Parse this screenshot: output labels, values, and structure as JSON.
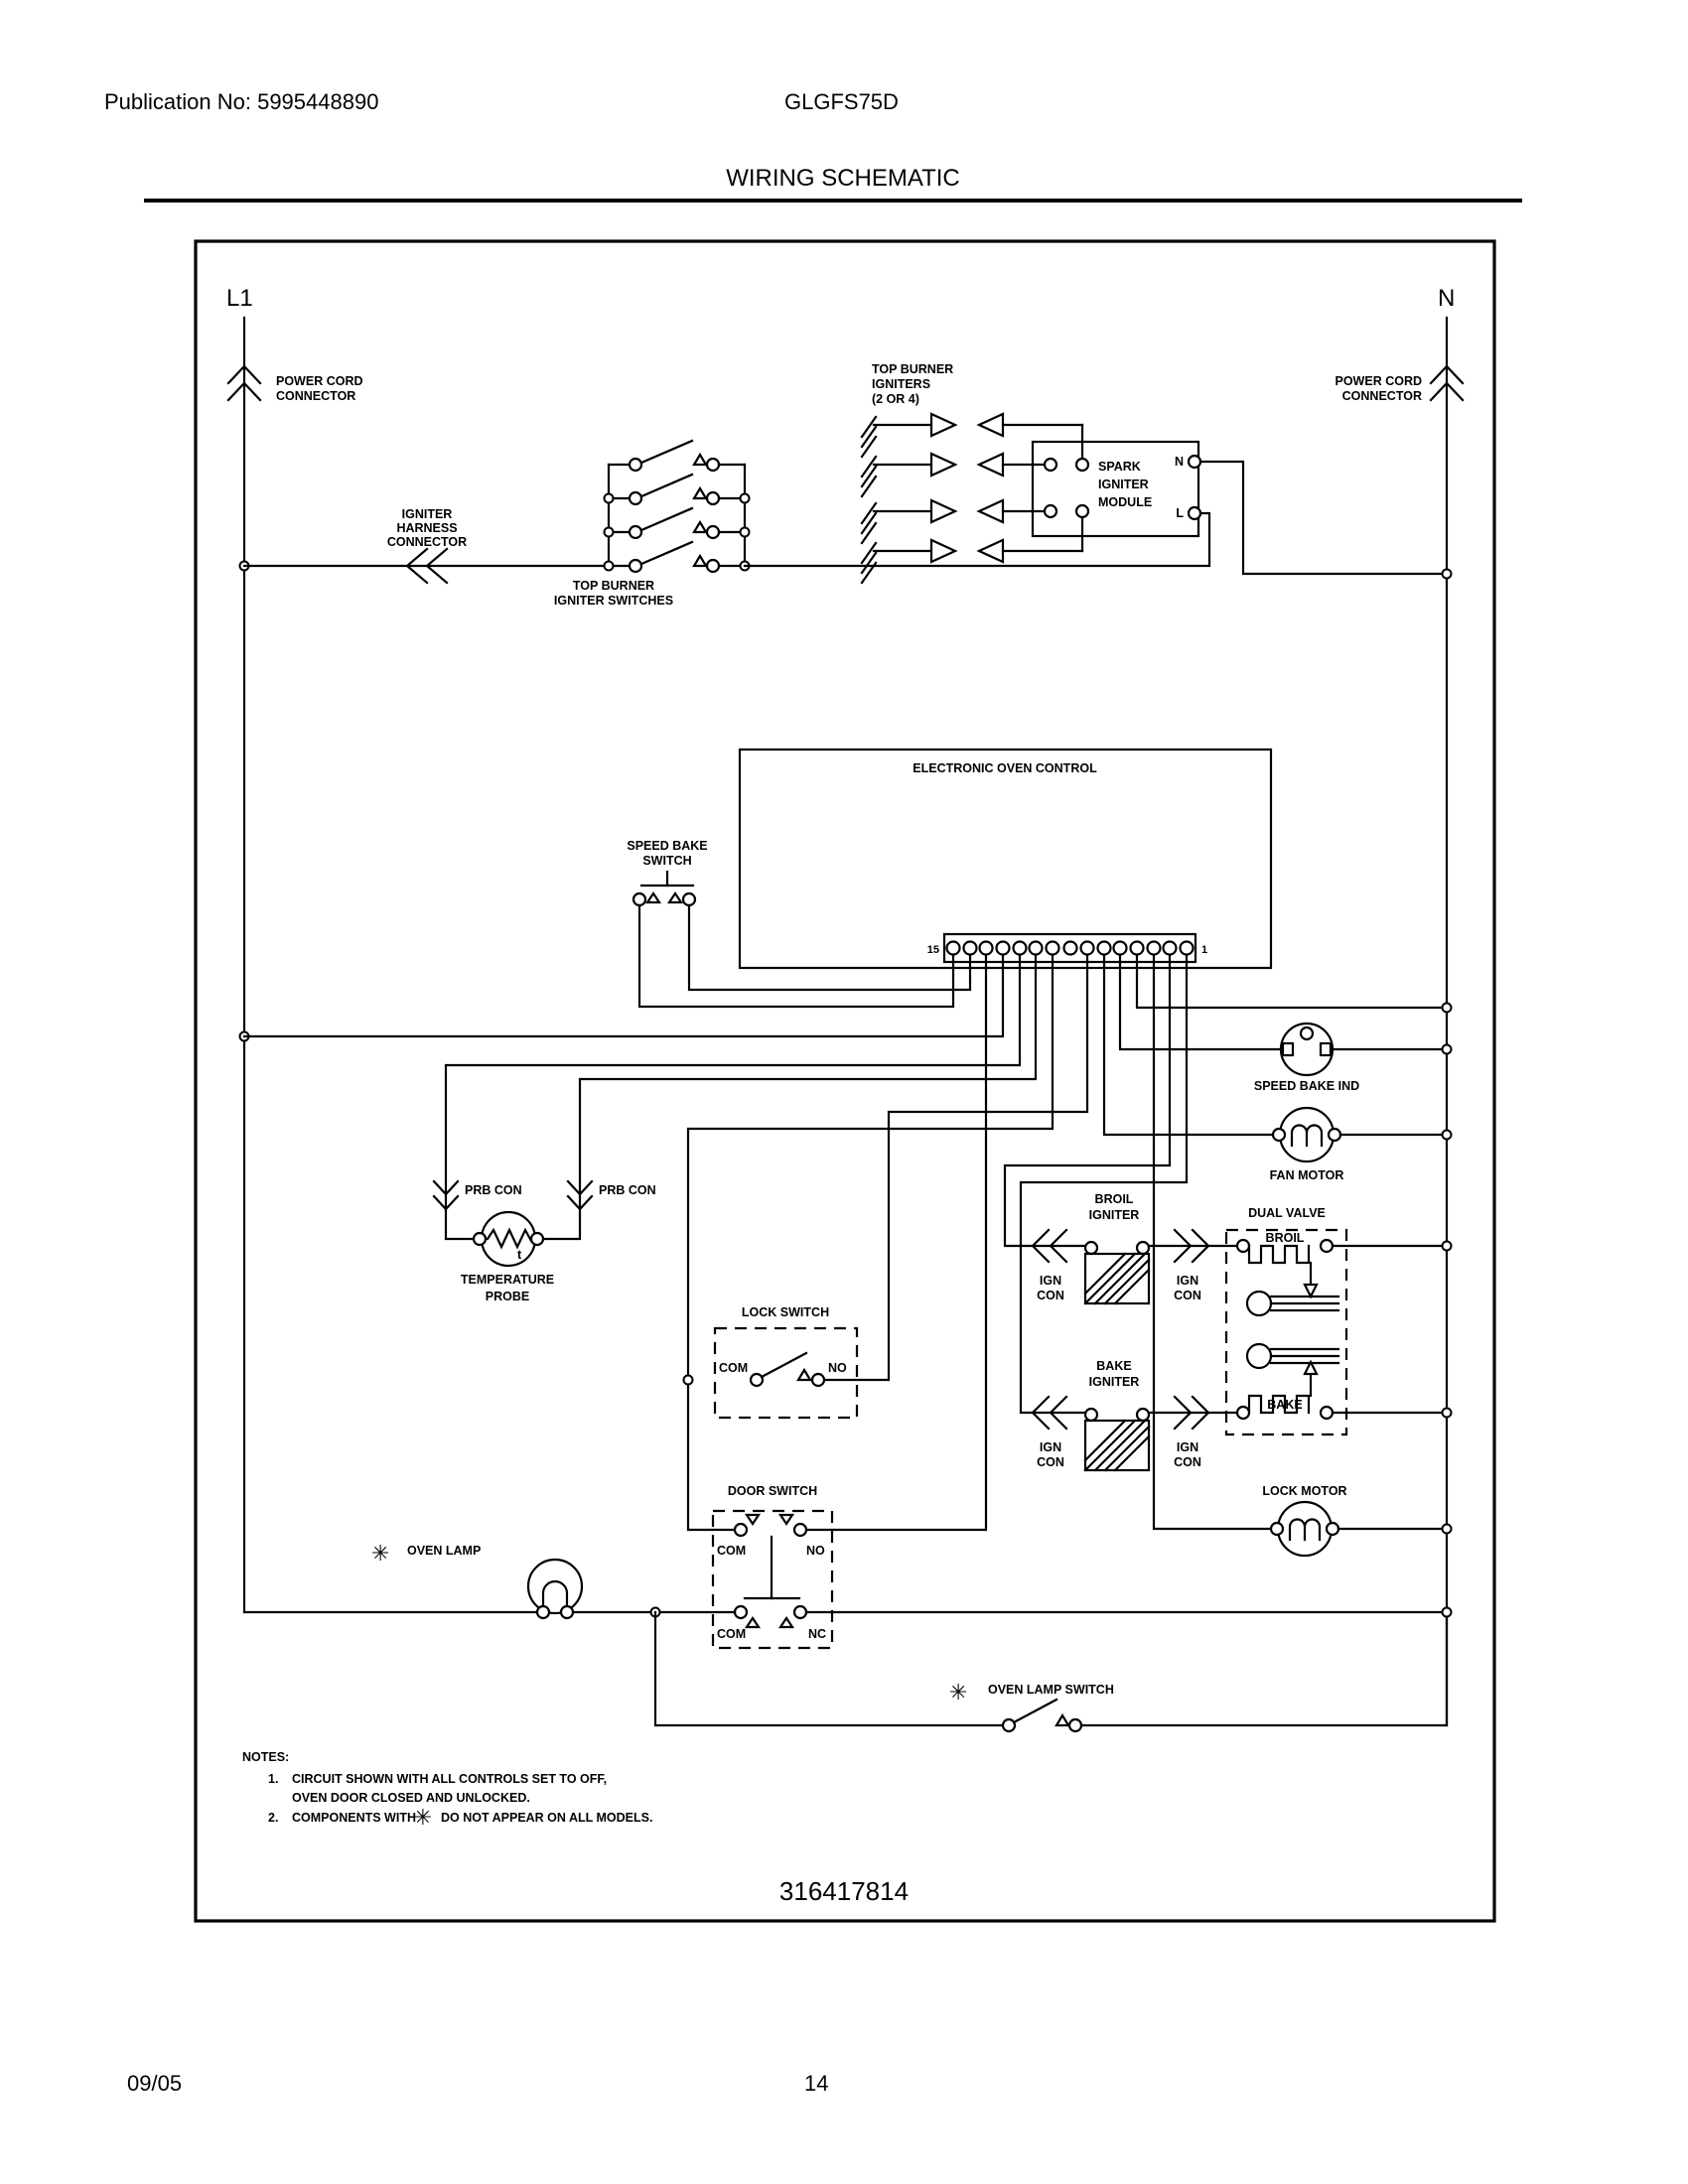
{
  "header": {
    "publication_no": "Publication No: 5995448890",
    "model": "GLGFS75D",
    "title": "WIRING SCHEMATIC"
  },
  "diagram": {
    "l1": "L1",
    "n": "N",
    "power_cord_connector": {
      "line1": "POWER CORD",
      "line2": "CONNECTOR"
    },
    "igniter_harness_connector": {
      "line1": "IGNITER",
      "line2": "HARNESS",
      "line3": "CONNECTOR"
    },
    "top_burner_igniter_switches": {
      "line1": "TOP BURNER",
      "line2": "IGNITER SWITCHES"
    },
    "top_burner_igniters": {
      "line1": "TOP BURNER",
      "line2": "IGNITERS",
      "line3": "(2 OR 4)"
    },
    "spark_igniter_module": {
      "line1": "SPARK",
      "line2": "IGNITER",
      "line3": "MODULE",
      "n_terminal": "N",
      "l_terminal": "L"
    },
    "electronic_oven_control": {
      "label": "ELECTRONIC OVEN CONTROL",
      "terminal_15": "15",
      "terminal_1": "1"
    },
    "speed_bake_switch": {
      "line1": "SPEED BAKE",
      "line2": "SWITCH"
    },
    "speed_bake_ind": "SPEED BAKE IND",
    "fan_motor": "FAN MOTOR",
    "prb_con_left": "PRB CON",
    "prb_con_right": "PRB CON",
    "temperature_probe": {
      "line1": "TEMPERATURE",
      "line2": "PROBE",
      "t": "t"
    },
    "lock_switch": {
      "label": "LOCK SWITCH",
      "com": "COM",
      "no": "NO"
    },
    "broil_igniter": {
      "line1": "BROIL",
      "line2": "IGNITER"
    },
    "bake_igniter": {
      "line1": "BAKE",
      "line2": "IGNITER"
    },
    "ign_con": {
      "line1": "IGN",
      "line2": "CON"
    },
    "dual_valve": {
      "label": "DUAL VALVE",
      "broil": "BROIL",
      "bake": "BAKE"
    },
    "lock_motor": "LOCK MOTOR",
    "door_switch": {
      "label": "DOOR SWITCH",
      "com_top": "COM",
      "no": "NO",
      "com_bottom": "COM",
      "nc": "NC"
    },
    "oven_lamp": {
      "asterisk": "✳",
      "label": "OVEN LAMP"
    },
    "oven_lamp_switch": {
      "asterisk": "✳",
      "label": "OVEN LAMP SWITCH"
    },
    "notes": {
      "heading": "NOTES:",
      "item1_no": "1.",
      "item1_line1": "CIRCUIT SHOWN WITH ALL CONTROLS SET TO OFF,",
      "item1_line2": "OVEN DOOR CLOSED AND UNLOCKED.",
      "item2_no": "2.",
      "item2_line1": "COMPONENTS WITH",
      "item2_asterisk": "✳",
      "item2_line2": "DO NOT APPEAR ON ALL MODELS."
    },
    "part_number": "316417814"
  },
  "footer": {
    "date": "09/05",
    "page": "14"
  }
}
